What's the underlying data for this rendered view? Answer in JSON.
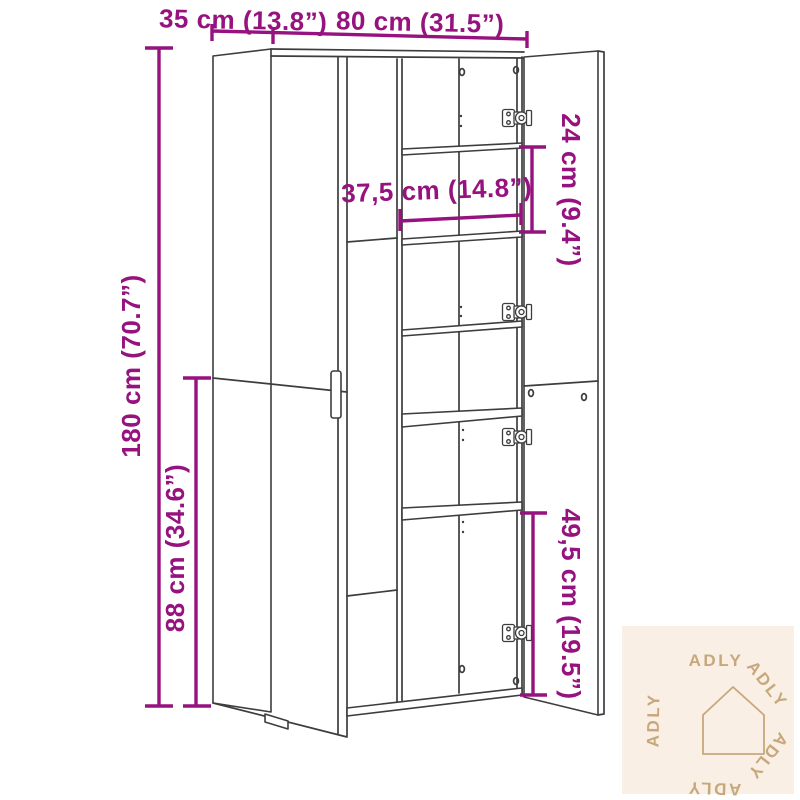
{
  "diagram": {
    "subject": "tall-cabinet-with-open-right-doors",
    "colors": {
      "dimension_accent": "#96127e",
      "cabinet_line": "#3d3d3d",
      "watermark_background": "#f9efe4",
      "watermark_foreground": "#c7a87c"
    },
    "labels": {
      "depth": "35 cm (13.8”)",
      "width": "80 cm (31.5”)",
      "height": "180 cm (70.7”)",
      "lower_door_height": "88 cm (34.6”)",
      "shelf_width": "37,5 cm (14.8”)",
      "upper_compartment_height": "24 cm (9.4”)",
      "lower_compartment_height": "49,5 cm (19.5”)"
    }
  },
  "watermark": {
    "brand": "ADLY"
  }
}
